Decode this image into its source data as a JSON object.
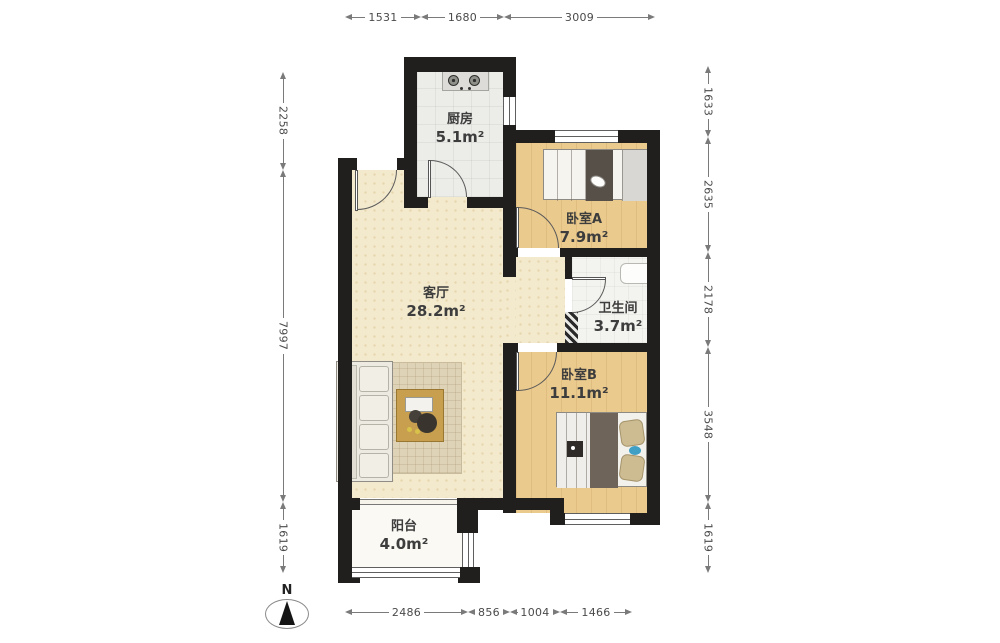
{
  "rooms": {
    "kitchen": {
      "name": "厨房",
      "area": "5.1m²"
    },
    "bedroom_a": {
      "name": "卧室A",
      "area": "7.9m²"
    },
    "living_room": {
      "name": "客厅",
      "area": "28.2m²"
    },
    "bathroom": {
      "name": "卫生间",
      "area": "3.7m²"
    },
    "bedroom_b": {
      "name": "卧室B",
      "area": "11.1m²"
    },
    "balcony": {
      "name": "阳台",
      "area": "4.0m²"
    }
  },
  "dimensions": {
    "top": [
      "1531",
      "1680",
      "3009"
    ],
    "bottom": [
      "2486",
      "856",
      "1004",
      "1466"
    ],
    "left": [
      "2258",
      "7997",
      "1619"
    ],
    "right": [
      "1633",
      "2635",
      "2178",
      "3548",
      "1619"
    ]
  },
  "compass": {
    "label": "N"
  },
  "colors": {
    "wall": "#211f1d",
    "living_floor": "#f3e9cd",
    "bedroom_floor": "#ebca8e",
    "kitchen_floor": "#ececea",
    "bathroom_floor": "#f3f3ef",
    "balcony_floor": "#faf9f4",
    "dimension_text": "#4a4a4a",
    "room_label_text": "#3d3d3d"
  }
}
